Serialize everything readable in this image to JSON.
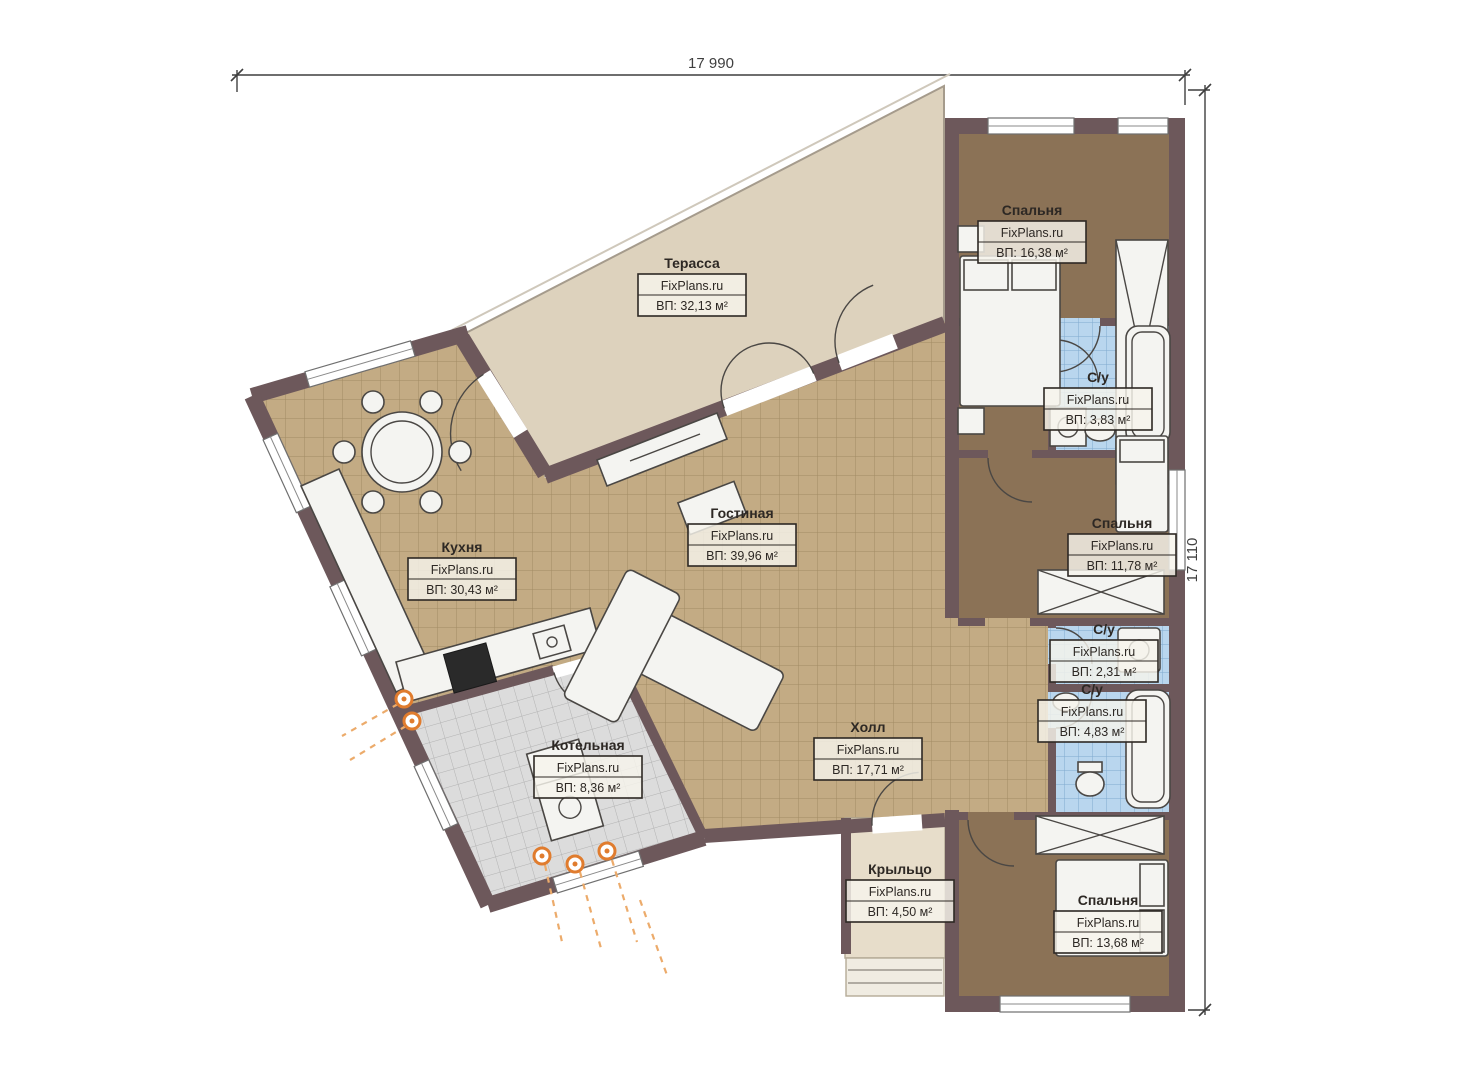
{
  "title": "План этажа",
  "brand": "FixPlans.ru",
  "dimensions": {
    "top": "17 990",
    "right": "17 110"
  },
  "rooms": [
    {
      "id": "terrace",
      "name": "Терасса",
      "area": "ВП: 32,13 м²"
    },
    {
      "id": "bedroom-1",
      "name": "Спальня",
      "area": "ВП: 16,38 м²"
    },
    {
      "id": "bathroom-1",
      "name": "С/у",
      "area": "ВП: 3,83 м²"
    },
    {
      "id": "bedroom-2",
      "name": "Спальня",
      "area": "ВП: 11,78 м²"
    },
    {
      "id": "bathroom-2",
      "name": "С/у",
      "area": "ВП: 2,31 м²"
    },
    {
      "id": "bathroom-3",
      "name": "С/у",
      "area": "ВП: 4,83 м²"
    },
    {
      "id": "bedroom-3",
      "name": "Спальня",
      "area": "ВП: 13,68 м²"
    },
    {
      "id": "kitchen",
      "name": "Кухня",
      "area": "ВП: 30,43 м²"
    },
    {
      "id": "living",
      "name": "Гостиная",
      "area": "ВП: 39,96 м²"
    },
    {
      "id": "hall",
      "name": "Холл",
      "area": "ВП: 17,71 м²"
    },
    {
      "id": "boiler",
      "name": "Котельная",
      "area": "ВП: 8,36 м²"
    },
    {
      "id": "porch",
      "name": "Крыльцо",
      "area": "ВП: 4,50 м²"
    }
  ],
  "colors": {
    "wall": "#6d585b",
    "terrace_floor": "#ddd2bd",
    "tile_floor": "#c3ab84",
    "tile_grid": "#a28b63",
    "bedroom_floor": "#8b7256",
    "bathroom_floor": "#b9d6ee",
    "bathroom_grid": "#7fa9cf",
    "boiler_floor": "#dcdcdc",
    "boiler_grid": "#b2b2b2",
    "porch_floor": "#e7ddca",
    "utility_orange": "#e07c2e",
    "dimension": "#3f3f3f"
  }
}
